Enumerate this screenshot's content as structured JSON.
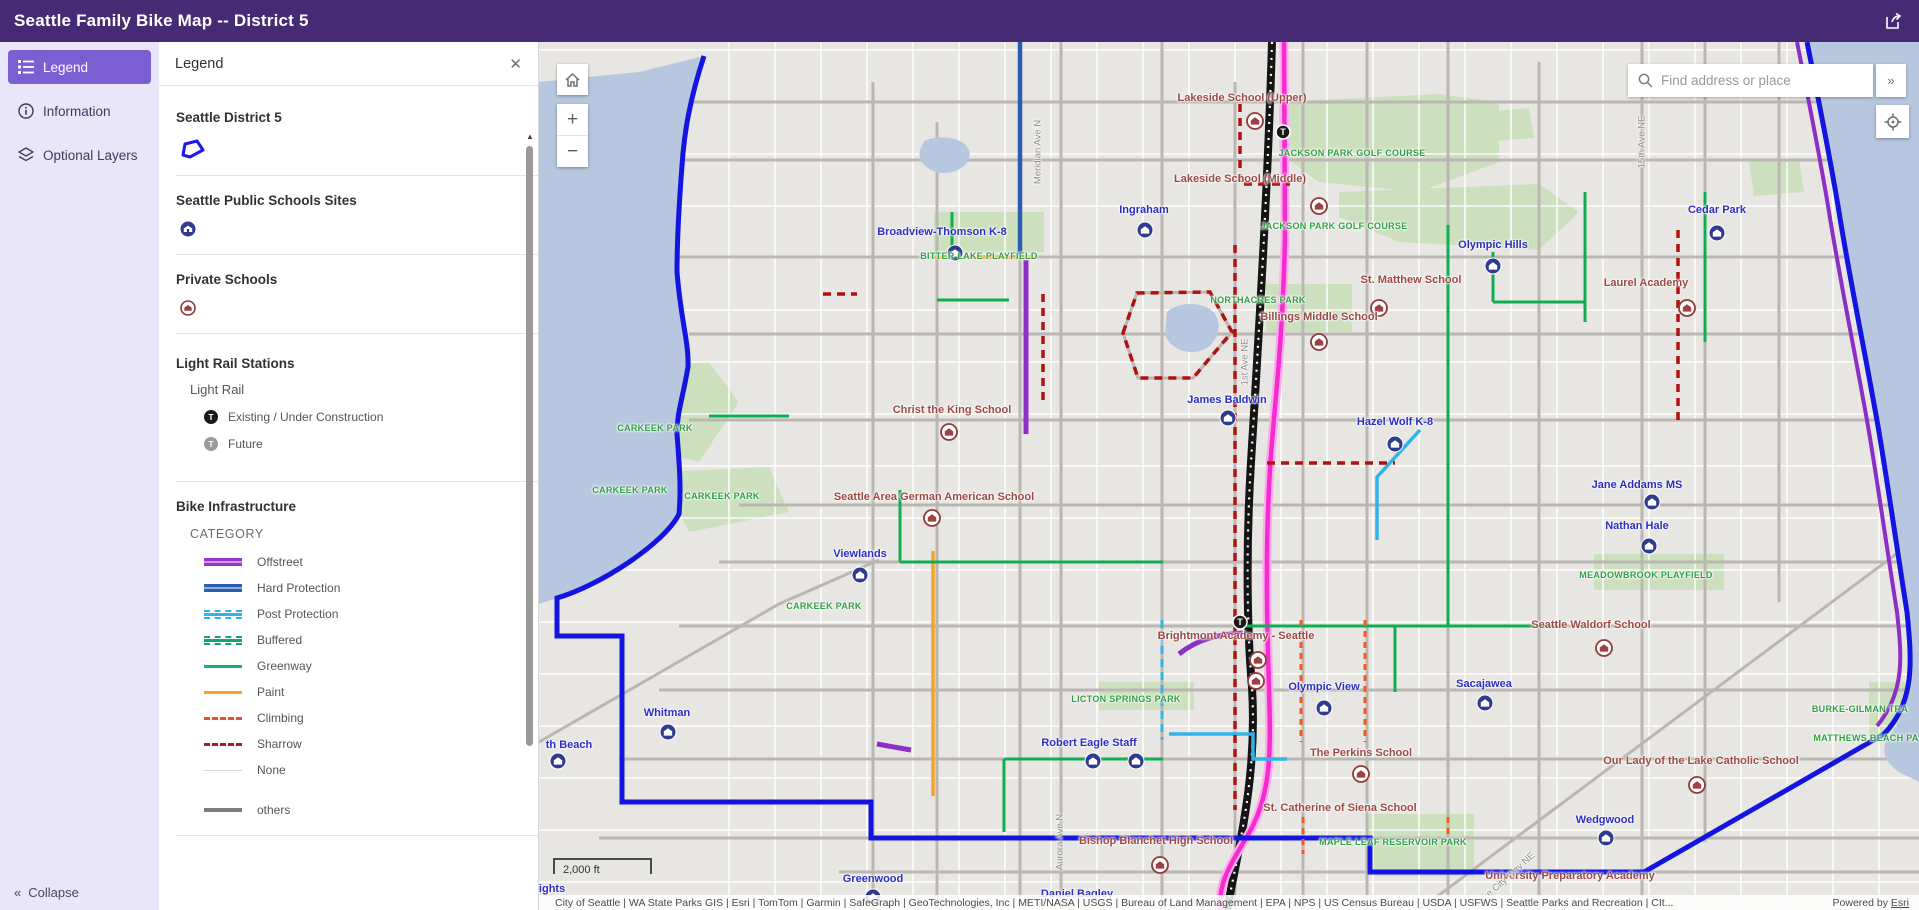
{
  "header": {
    "title": "Seattle Family Bike Map -- District 5"
  },
  "sidebar": {
    "items": [
      {
        "label": "Legend"
      },
      {
        "label": "Information"
      },
      {
        "label": "Optional Layers"
      }
    ],
    "collapse_label": "Collapse"
  },
  "legend_panel": {
    "title": "Legend",
    "sections": [
      {
        "heading": "Seattle District 5"
      },
      {
        "heading": "Seattle Public Schools Sites"
      },
      {
        "heading": "Private Schools"
      },
      {
        "heading": "Light Rail Stations",
        "sublayer": "Light Rail",
        "items": [
          {
            "label": "Existing / Under Construction",
            "swatch": "station-dark",
            "color": "#1a1a1a"
          },
          {
            "label": "Future",
            "swatch": "station-gray",
            "color": "#9a9a9a"
          }
        ]
      },
      {
        "heading": "Bike Infrastructure",
        "field": "CATEGORY",
        "items": [
          {
            "label": "Offstreet",
            "color": "#9a35cf",
            "style": "double"
          },
          {
            "label": "Hard Protection",
            "color": "#2a5db0",
            "style": "double"
          },
          {
            "label": "Post Protection",
            "color": "#2fb4ea",
            "style": "dashed-rails"
          },
          {
            "label": "Buffered",
            "color": "#0fa67c",
            "style": "dashed-rails"
          },
          {
            "label": "Greenway",
            "color": "#16b269",
            "style": "solid"
          },
          {
            "label": "Paint",
            "color": "#f4a426",
            "style": "solid"
          },
          {
            "label": "Climbing",
            "color": "#e65426",
            "style": "dashed"
          },
          {
            "label": "Sharrow",
            "color": "#a51f23",
            "style": "dashed"
          },
          {
            "label": "None",
            "color": "#d9d9d9",
            "style": "thin"
          },
          {
            "label": "others",
            "color": "#7d7d7d",
            "style": "solid-thick"
          }
        ]
      }
    ]
  },
  "map": {
    "search": {
      "placeholder": "Find address or place"
    },
    "scalebar": "2,000 ft",
    "attribution": "City of Seattle | WA State Parks GIS | Esri | TomTom | Garmin | SafeGraph | GeoTechnologies, Inc | METI/NASA | USGS | Bureau of Land Management | EPA | NPS | US Census Bureau | USDA | USFWS | Seattle Parks and Recreation | CIt...",
    "powered_prefix": "Powered by ",
    "powered_link": "Esri",
    "route_colors": {
      "road": "#bab7b3",
      "water": "#b7c7df",
      "park": "#cde0be",
      "boundary": "#1414e0",
      "offstreet": "#8c2fc4",
      "hard": "#2a5db0",
      "post": "#2fb4ea",
      "greenway": "#0fae53",
      "paint": "#f4a426",
      "climbing": "#f4581e",
      "sharrow": "#b01212",
      "lightrail": "#f52ccd",
      "lightrail_halo": "#fbaced",
      "i5": "#141414",
      "school_public": "#303a8e",
      "school_private": "#8d3b3b"
    },
    "parks": [
      "M740,60 L900,52 L960,60 L960,120 L880,150 L780,140 L740,110 Z",
      "M800,150 L1000,142 L1040,170 L1000,208 L860,200 L800,175 Z",
      "M727,242 L813,242 L813,290 L727,290 Z",
      "M395,170 L505,170 L505,210 L395,210 Z",
      "M60,330 L170,320 L200,360 L160,420 L80,400 Z",
      "M120,430 L230,425 L250,470 L150,490 Z",
      "M1055,512 L1185,512 L1185,548 L1055,548 Z",
      "M560,640 L655,640 L655,668 L560,668 Z",
      "M828,772 L935,772 L935,834 L828,834 Z",
      "M1330,640 L1368,640 L1368,700 L1330,700 Z",
      "M940,70 L990,66 L995,96 L945,100 Z",
      "M1210,120 L1260,116 L1265,150 L1215,154 Z"
    ],
    "waters": [
      "M0,40 L100,30 L165,14 C150,60 146,90 144,111 C140,160 138,200 138,230 C142,280 150,300 149,325 C143,360 138,370 138,392 C141,430 142,450 140,472 C120,505 60,545 18,556 L0,562 Z",
      "M1380,0 L1268,0 C1280,60 1292,120 1300,170 C1313,250 1328,320 1340,390 C1350,450 1360,520 1368,570 C1373,620 1376,660 1352,692 C1340,705 1345,720 1360,730 L1380,740 Z",
      "M385,99 C400,92 425,95 430,108 C434,120 420,132 403,131 C388,130 378,118 381,108 Z",
      "M628,270 C640,258 668,260 676,272 C684,284 678,302 664,308 C648,314 630,306 626,292 Z"
    ],
    "roads": [
      "M334,40V868",
      "M398,80V868",
      "M481,0V868",
      "M522,0V868",
      "M623,0V868",
      "M696,40V868",
      "M764,0V868",
      "M828,0V868",
      "M909,0V868",
      "M1000,20V868",
      "M1103,0V868",
      "M1166,0V800",
      "M1240,0V560",
      "M120,60H1280",
      "M100,118H1300",
      "M140,215H1340",
      "M150,292H1350",
      "M150,378H1360",
      "M200,463H1365",
      "M180,520H1370",
      "M140,584H1370",
      "M120,648H1375",
      "M80,717H1370",
      "M60,796H1380",
      "M300,830H1380",
      "M880,868L1380,495",
      "M0,700L240,562L340,518",
      "M584,291L598,251L671,250L693,290L654,336L599,336Z"
    ],
    "routes": [
      {
        "c": "i5",
        "w": 8,
        "d": "M733,0 C729,140 720,290 712,420 C706,520 709,600 713,645 C718,730 703,790 688,868"
      },
      {
        "c": "lightrail",
        "w": 4.5,
        "d": "M745,0 L746,195 C744,290 737,350 733,400 C727,470 727,540 729,610 C731,700 737,748 706,798 C690,824 678,845 682,868"
      },
      {
        "c": "boundary",
        "w": 5,
        "d": "M165,14 C150,60 146,90 144,111 C140,160 138,200 138,230 C142,280 150,300 149,325 C143,360 138,370 138,392 C141,430 142,450 140,472 C125,502 60,544 18,556 L18,594 L83,594 L83,760 L332,760 L332,796 L831,796 L831,830 L1105,830 L1345,692"
      },
      {
        "c": "boundary",
        "w": 5,
        "d": "M1268,0 C1280,60 1292,120 1300,170 C1313,250 1328,320 1340,390 C1350,450 1360,520 1368,570 C1373,620 1376,660 1345,692"
      },
      {
        "c": "offstreet",
        "w": 4,
        "d": "M1258,0 C1270,60 1282,120 1290,170 C1303,250 1318,320 1330,390 C1340,450 1350,520 1358,570 C1363,615 1366,650 1338,684"
      },
      {
        "c": "hard",
        "w": 4.5,
        "d": "M481,0V215"
      },
      {
        "c": "offstreet",
        "w": 5,
        "d": "M487,218V392"
      },
      {
        "c": "offstreet",
        "w": 5,
        "d": "M640,612 C660,596 682,592 704,591"
      },
      {
        "c": "offstreet",
        "w": 5,
        "d": "M338,702L372,708"
      },
      {
        "c": "paint",
        "w": 3.5,
        "d": "M396,215H497"
      },
      {
        "c": "paint",
        "w": 3.5,
        "d": "M394,509V754"
      },
      {
        "c": "greenway",
        "w": 3,
        "d": "M361,448V520"
      },
      {
        "c": "greenway",
        "w": 3,
        "d": "M361,520H624"
      },
      {
        "c": "greenway",
        "w": 3,
        "d": "M909,183V584"
      },
      {
        "c": "greenway",
        "w": 3,
        "d": "M700,584H1021"
      },
      {
        "c": "greenway",
        "w": 3,
        "d": "M856,584V650"
      },
      {
        "c": "greenway",
        "w": 3,
        "d": "M1046,150V280"
      },
      {
        "c": "greenway",
        "w": 3,
        "d": "M1166,150V300"
      },
      {
        "c": "greenway",
        "w": 3,
        "d": "M954,210V260"
      },
      {
        "c": "greenway",
        "w": 3,
        "d": "M954,260H1046"
      },
      {
        "c": "greenway",
        "w": 3,
        "d": "M413,170V215"
      },
      {
        "c": "greenway",
        "w": 3,
        "d": "M398,258H470"
      },
      {
        "c": "greenway",
        "w": 3,
        "d": "M465,717H624"
      },
      {
        "c": "greenway",
        "w": 3,
        "d": "M465,717V790"
      },
      {
        "c": "greenway",
        "w": 3,
        "d": "M170,374H250"
      },
      {
        "c": "post",
        "w": 3.5,
        "d": "M881,388 L838,435 V498"
      },
      {
        "c": "post",
        "w": 3.5,
        "d": "M630,692 H714 V717 H748"
      },
      {
        "c": "post",
        "w": 3,
        "dash": "8 5",
        "d": "M623,578V698"
      },
      {
        "c": "climbing",
        "w": 3,
        "dash": "6 5",
        "d": "M762,578V700"
      },
      {
        "c": "climbing",
        "w": 3,
        "dash": "6 5",
        "d": "M826,578V700"
      },
      {
        "c": "climbing",
        "w": 3,
        "dash": "6 5",
        "d": "M764,775V812"
      },
      {
        "c": "climbing",
        "w": 3,
        "dash": "6 5",
        "d": "M909,775V800"
      },
      {
        "c": "sharrow",
        "w": 3.5,
        "dash": "8 6",
        "d": "M584,291L598,251L671,250L693,290L654,336L599,336Z"
      },
      {
        "c": "sharrow",
        "w": 3.5,
        "dash": "8 6",
        "d": "M696,203V768"
      },
      {
        "c": "sharrow",
        "w": 3.5,
        "dash": "8 6",
        "d": "M504,252V362"
      },
      {
        "c": "sharrow",
        "w": 3.5,
        "dash": "8 6",
        "d": "M728,421H856"
      },
      {
        "c": "sharrow",
        "w": 3.5,
        "dash": "8 6",
        "d": "M1139,188V378"
      },
      {
        "c": "sharrow",
        "w": 3.5,
        "dash": "8 6",
        "d": "M701,62V142H751"
      },
      {
        "c": "sharrow",
        "w": 3.5,
        "dash": "8 6",
        "d": "M284,252H318"
      }
    ],
    "stations": [
      {
        "x": 744,
        "y": 90
      },
      {
        "x": 701,
        "y": 580
      }
    ],
    "schools_public": [
      {
        "x": 416,
        "y": 211
      },
      {
        "x": 606,
        "y": 188
      },
      {
        "x": 1178,
        "y": 191
      },
      {
        "x": 954,
        "y": 224
      },
      {
        "x": 689,
        "y": 376
      },
      {
        "x": 856,
        "y": 402
      },
      {
        "x": 1113,
        "y": 460
      },
      {
        "x": 1110,
        "y": 504
      },
      {
        "x": 321,
        "y": 533
      },
      {
        "x": 946,
        "y": 661
      },
      {
        "x": 785,
        "y": 666
      },
      {
        "x": 129,
        "y": 690
      },
      {
        "x": 19,
        "y": 719
      },
      {
        "x": 554,
        "y": 719
      },
      {
        "x": 597,
        "y": 719
      },
      {
        "x": 334,
        "y": 855
      },
      {
        "x": 1067,
        "y": 796
      }
    ],
    "schools_private": [
      {
        "x": 716,
        "y": 79
      },
      {
        "x": 780,
        "y": 164
      },
      {
        "x": 840,
        "y": 266
      },
      {
        "x": 1148,
        "y": 266
      },
      {
        "x": 780,
        "y": 300
      },
      {
        "x": 410,
        "y": 390
      },
      {
        "x": 393,
        "y": 476
      },
      {
        "x": 719,
        "y": 618
      },
      {
        "x": 717,
        "y": 639
      },
      {
        "x": 1065,
        "y": 606
      },
      {
        "x": 822,
        "y": 732
      },
      {
        "x": 1158,
        "y": 743
      },
      {
        "x": 621,
        "y": 823
      }
    ],
    "labels": [
      {
        "t": "Lakeside School (Upper)",
        "x": 703,
        "y": 56,
        "k": "private"
      },
      {
        "t": "JACKSON PARK GOLF COURSE",
        "x": 813,
        "y": 111,
        "k": "park"
      },
      {
        "t": "Lakeside School (Middle)",
        "x": 701,
        "y": 137,
        "k": "private"
      },
      {
        "t": "JACKSON PARK GOLF COURSE",
        "x": 795,
        "y": 184,
        "k": "park"
      },
      {
        "t": "Ingraham",
        "x": 605,
        "y": 168,
        "k": "public"
      },
      {
        "t": "Broadview-Thomson K-8",
        "x": 403,
        "y": 190,
        "k": "public"
      },
      {
        "t": "BITTER LAKE PLAYFIELD",
        "x": 440,
        "y": 214,
        "k": "park"
      },
      {
        "t": "Cedar Park",
        "x": 1178,
        "y": 168,
        "k": "public"
      },
      {
        "t": "Olympic Hills",
        "x": 954,
        "y": 203,
        "k": "public"
      },
      {
        "t": "Laurel Academy",
        "x": 1107,
        "y": 241,
        "k": "private"
      },
      {
        "t": "St. Matthew School",
        "x": 872,
        "y": 238,
        "k": "private"
      },
      {
        "t": "NORTHACRES PARK",
        "x": 719,
        "y": 258,
        "k": "park"
      },
      {
        "t": "Billings Middle School",
        "x": 780,
        "y": 275,
        "k": "private"
      },
      {
        "t": "Christ the King School",
        "x": 413,
        "y": 368,
        "k": "private"
      },
      {
        "t": "James Baldwin",
        "x": 688,
        "y": 358,
        "k": "public"
      },
      {
        "t": "Hazel Wolf K-8",
        "x": 856,
        "y": 380,
        "k": "public"
      },
      {
        "t": "CARKEEK PARK",
        "x": 116,
        "y": 386,
        "k": "park"
      },
      {
        "t": "CARKEEK PARK",
        "x": 91,
        "y": 448,
        "k": "park"
      },
      {
        "t": "CARKEEK PARK",
        "x": 183,
        "y": 454,
        "k": "park"
      },
      {
        "t": "Seattle Area German American School",
        "x": 395,
        "y": 455,
        "k": "private"
      },
      {
        "t": "Jane Addams MS",
        "x": 1098,
        "y": 443,
        "k": "public"
      },
      {
        "t": "Nathan Hale",
        "x": 1098,
        "y": 484,
        "k": "public"
      },
      {
        "t": "MEADOWBROOK PLAYFIELD",
        "x": 1107,
        "y": 533,
        "k": "park"
      },
      {
        "t": "Viewlands",
        "x": 321,
        "y": 512,
        "k": "public"
      },
      {
        "t": "CARKEEK PARK",
        "x": 285,
        "y": 564,
        "k": "park"
      },
      {
        "t": "Brightmont Academy - Seattle",
        "x": 697,
        "y": 594,
        "k": "private"
      },
      {
        "t": "Seattle Waldorf School",
        "x": 1052,
        "y": 583,
        "k": "private"
      },
      {
        "t": "Sacajawea",
        "x": 945,
        "y": 642,
        "k": "public"
      },
      {
        "t": "Olympic View",
        "x": 785,
        "y": 645,
        "k": "public"
      },
      {
        "t": "LICTON SPRINGS PARK",
        "x": 587,
        "y": 657,
        "k": "park"
      },
      {
        "t": "Whitman",
        "x": 128,
        "y": 671,
        "k": "public"
      },
      {
        "t": "th Beach",
        "x": 30,
        "y": 703,
        "k": "public"
      },
      {
        "t": "Robert Eagle Staff",
        "x": 550,
        "y": 701,
        "k": "public"
      },
      {
        "t": "The Perkins School",
        "x": 822,
        "y": 711,
        "k": "private"
      },
      {
        "t": "Our Lady of the Lake Catholic School",
        "x": 1162,
        "y": 719,
        "k": "private"
      },
      {
        "t": "St. Catherine of Siena School",
        "x": 801,
        "y": 766,
        "k": "private"
      },
      {
        "t": "Wedgwood",
        "x": 1066,
        "y": 778,
        "k": "public"
      },
      {
        "t": "BURKE-GILMAN TRA",
        "x": 1321,
        "y": 667,
        "k": "park"
      },
      {
        "t": "MATTHEWS BEACH PA",
        "x": 1327,
        "y": 696,
        "k": "park"
      },
      {
        "t": "Bishop Blanchet High School",
        "x": 617,
        "y": 799,
        "k": "private"
      },
      {
        "t": "MAPLE LEAF RESERVOIR PARK",
        "x": 854,
        "y": 800,
        "k": "park"
      },
      {
        "t": "University Preparatory Academy",
        "x": 1031,
        "y": 834,
        "k": "private"
      },
      {
        "t": "Greenwood",
        "x": 334,
        "y": 837,
        "k": "public"
      },
      {
        "t": "Daniel Bagley",
        "x": 538,
        "y": 852,
        "k": "public"
      },
      {
        "t": "eights",
        "x": 10,
        "y": 847,
        "k": "public"
      },
      {
        "t": "Meridian Ave N",
        "x": 499,
        "y": 110,
        "k": "street",
        "r": -90
      },
      {
        "t": "1st Ave NE",
        "x": 706,
        "y": 320,
        "k": "street",
        "r": -90
      },
      {
        "t": "Aurora Ave N",
        "x": 521,
        "y": 800,
        "k": "street",
        "r": -90
      },
      {
        "t": "15th Ave NE",
        "x": 1103,
        "y": 100,
        "k": "street",
        "r": -90
      },
      {
        "t": "Lake City Way NE",
        "x": 966,
        "y": 838,
        "k": "street",
        "r": -42
      }
    ]
  }
}
